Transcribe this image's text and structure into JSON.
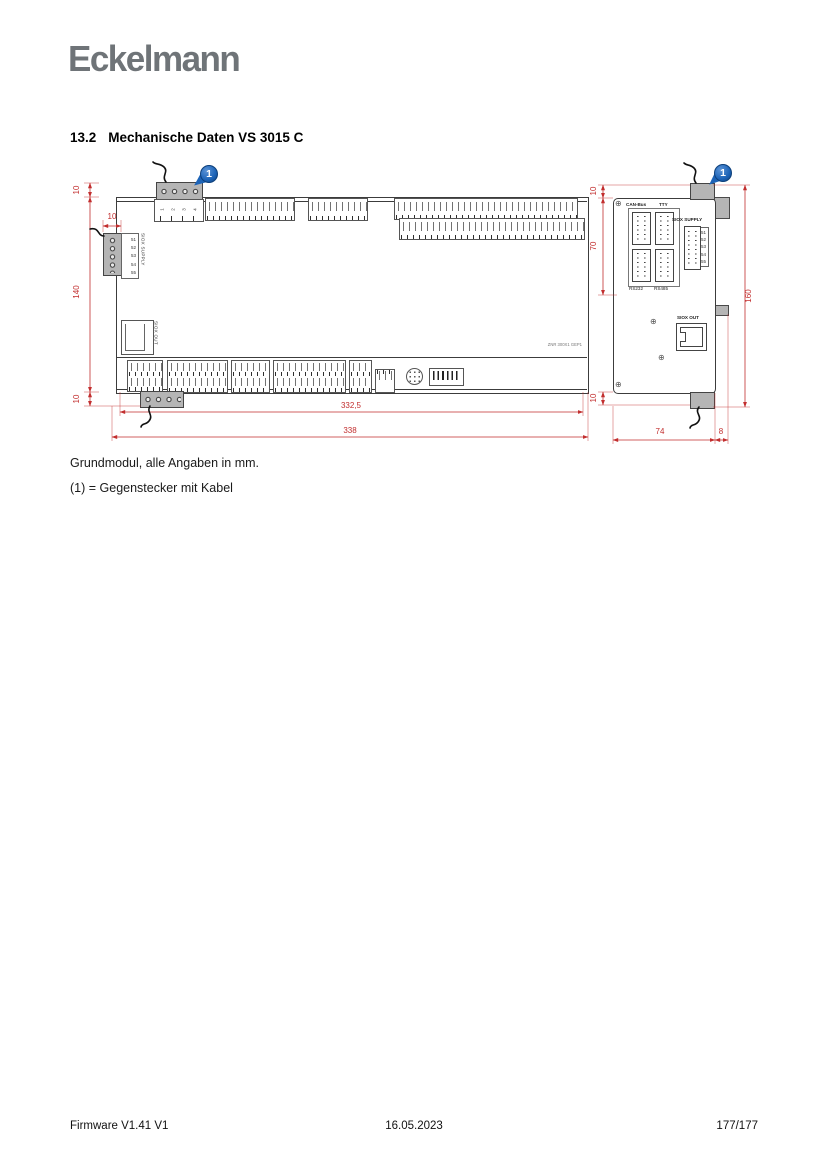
{
  "page": {
    "logo_text": "Eckelmann",
    "heading_number": "13.2",
    "heading_title": "Mechanische Daten VS 3015 C",
    "caption_line1": "Grundmodul, alle Angaben in mm.",
    "caption_line2": "(1) = Gegenstecker mit Kabel",
    "footer_left": "Firmware V1.41 V1",
    "footer_center": "16.05.2023",
    "footer_right": "177/177"
  },
  "drawing": {
    "callout_label": "1",
    "colors": {
      "dimension_red": "#c22e2e",
      "callout_blue": "#1c63b7",
      "connector_gray": "#b5b5b5"
    },
    "front": {
      "dim_top_offset": "10",
      "dim_supply_conn": "10",
      "dim_height": "140",
      "dim_bottom_offset": "10",
      "dim_width_inner": "332,5",
      "dim_width_outer": "338",
      "power_pins": [
        "1",
        "2",
        "3",
        "4"
      ],
      "supply_label": "SIOX SUPPLY",
      "supply_pins": [
        "51",
        "52",
        "53",
        "54",
        "55"
      ],
      "siox_out_label": "SIOX OUT",
      "board_ref": "ZNR 300X1 GEP1"
    },
    "side": {
      "dim_top_offset": "10",
      "dim_upper_section": "70",
      "dim_bottom_offset": "10",
      "dim_total_height": "160",
      "dim_body_width": "74",
      "dim_tab_depth": "8",
      "label_canbus": "CAN-Bus",
      "label_tty": "TTY",
      "label_rs232": "RS232",
      "label_rs485": "RS485",
      "label_siox_supply": "SIOX SUPPLY",
      "label_siox_out": "SIOX OUT",
      "supply_pins": [
        "51",
        "52",
        "53",
        "54",
        "55"
      ]
    }
  }
}
